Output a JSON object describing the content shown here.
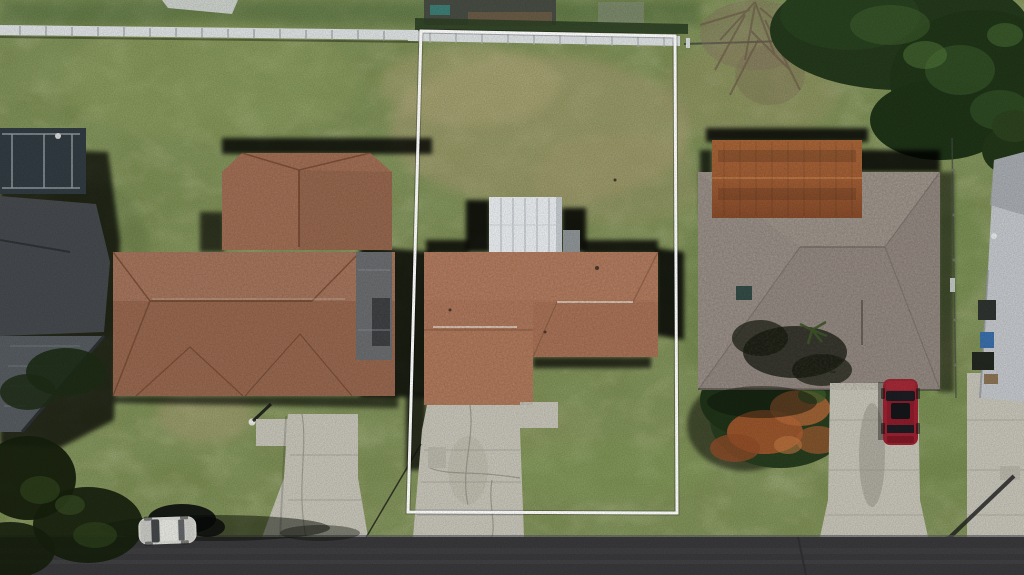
{
  "scene": {
    "kind": "aerial-drone-photo",
    "description": "Top-down aerial photo of a residential street with three homes; the center vacant-style lot with a brown-shingle house is outlined in white (real-estate listing highlight).",
    "colors": {
      "grass": "#7a8b52",
      "grass_dark": "#54703f",
      "grass_dry": "#a99e74",
      "road": "#39393b",
      "concrete": "#c6c4b8",
      "roof_left": "#a57056",
      "roof_middle": "#b37a5e",
      "roof_right": "#9c938c",
      "roof_right_gable": "#a55e33",
      "roof_far_left": "#45494d",
      "roof_far_right": "#c3c6ca",
      "shed_white": "#e9ecef",
      "fence_white": "#dde1e2",
      "tree_canopy": "#24391c",
      "bush_red": "#a4582e",
      "car_white": "#dadad5",
      "car_red": "#9c2130",
      "boundary": "#ffffff",
      "shadow": "#000000"
    },
    "objects": {
      "property_boundary": "white outlined lot boundary around center property",
      "subject_house": "center house, orange-brown shingle L-shaped roof with white shed structure",
      "left_house": "left neighbor house, brown shingle hip roof with gray lanai",
      "right_house": "right neighbor house, weathered gray hip roof with rust corrugated gable",
      "far_left_house": "edge-of-frame neighbor with dark roof and screened enclosure",
      "far_right_house": "edge-of-frame neighbor with light gray roof and yard clutter",
      "white_shed": "white panelled utility structure behind subject house",
      "red_car": "red SUV parked on right driveway",
      "white_car": "white car parked at street edge",
      "street": "asphalt street along bottom of frame",
      "driveways": "concrete driveways to each home",
      "back_fence": "light gray privacy fence along rear of lots",
      "tree_canopy": "dense dark green tree canopy, top right",
      "red_bush": "large orange-red and green bush between lots",
      "utility_pole_shadow": "diagonal pole shadow on right lawn"
    }
  }
}
